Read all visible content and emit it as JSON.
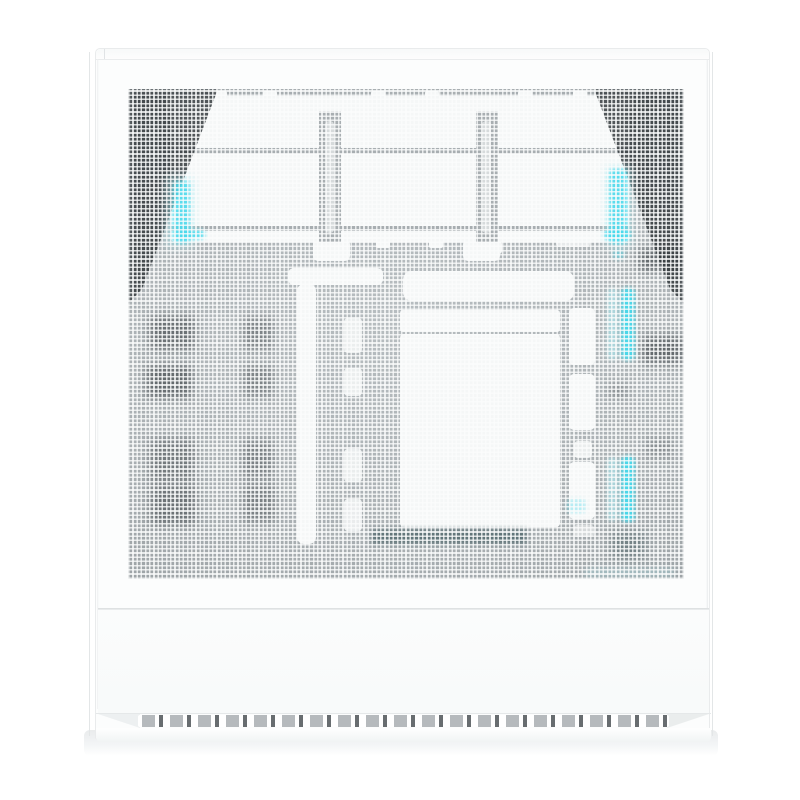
{
  "scene": {
    "type": "product-photo",
    "subject": "White mid-tower PC case, front mesh panel view with cyan RGB glow",
    "background_color": "#ffffff"
  },
  "case": {
    "body_color": "#fcfdfd",
    "edge_color": "#e9ebec",
    "panels": {
      "top_lip": "top panel lip",
      "front_mesh": "perforated mesh front panel",
      "lower_front": "solid lower front panel",
      "seam": "horizontal panel seam"
    },
    "mesh": {
      "base_cell_color": "#a9afb2",
      "wire_color": "#fbfcfc",
      "silhouette_color": "#f5f7f7",
      "shadow_color": "#343a3e",
      "fans_visible": 3,
      "rgb_glow_color": "#45d9ec",
      "rgb_glow_soft": "#a9ebf3",
      "rgb_strip_segments": 4,
      "component_shadow_blotches": 14
    },
    "base": {
      "vent_slot_wide_color": "#b6babd",
      "vent_slot_narrow_color": "#686d70",
      "vent_slot_pairs": 19,
      "floor_shadow_color": "#e9ebec"
    }
  }
}
